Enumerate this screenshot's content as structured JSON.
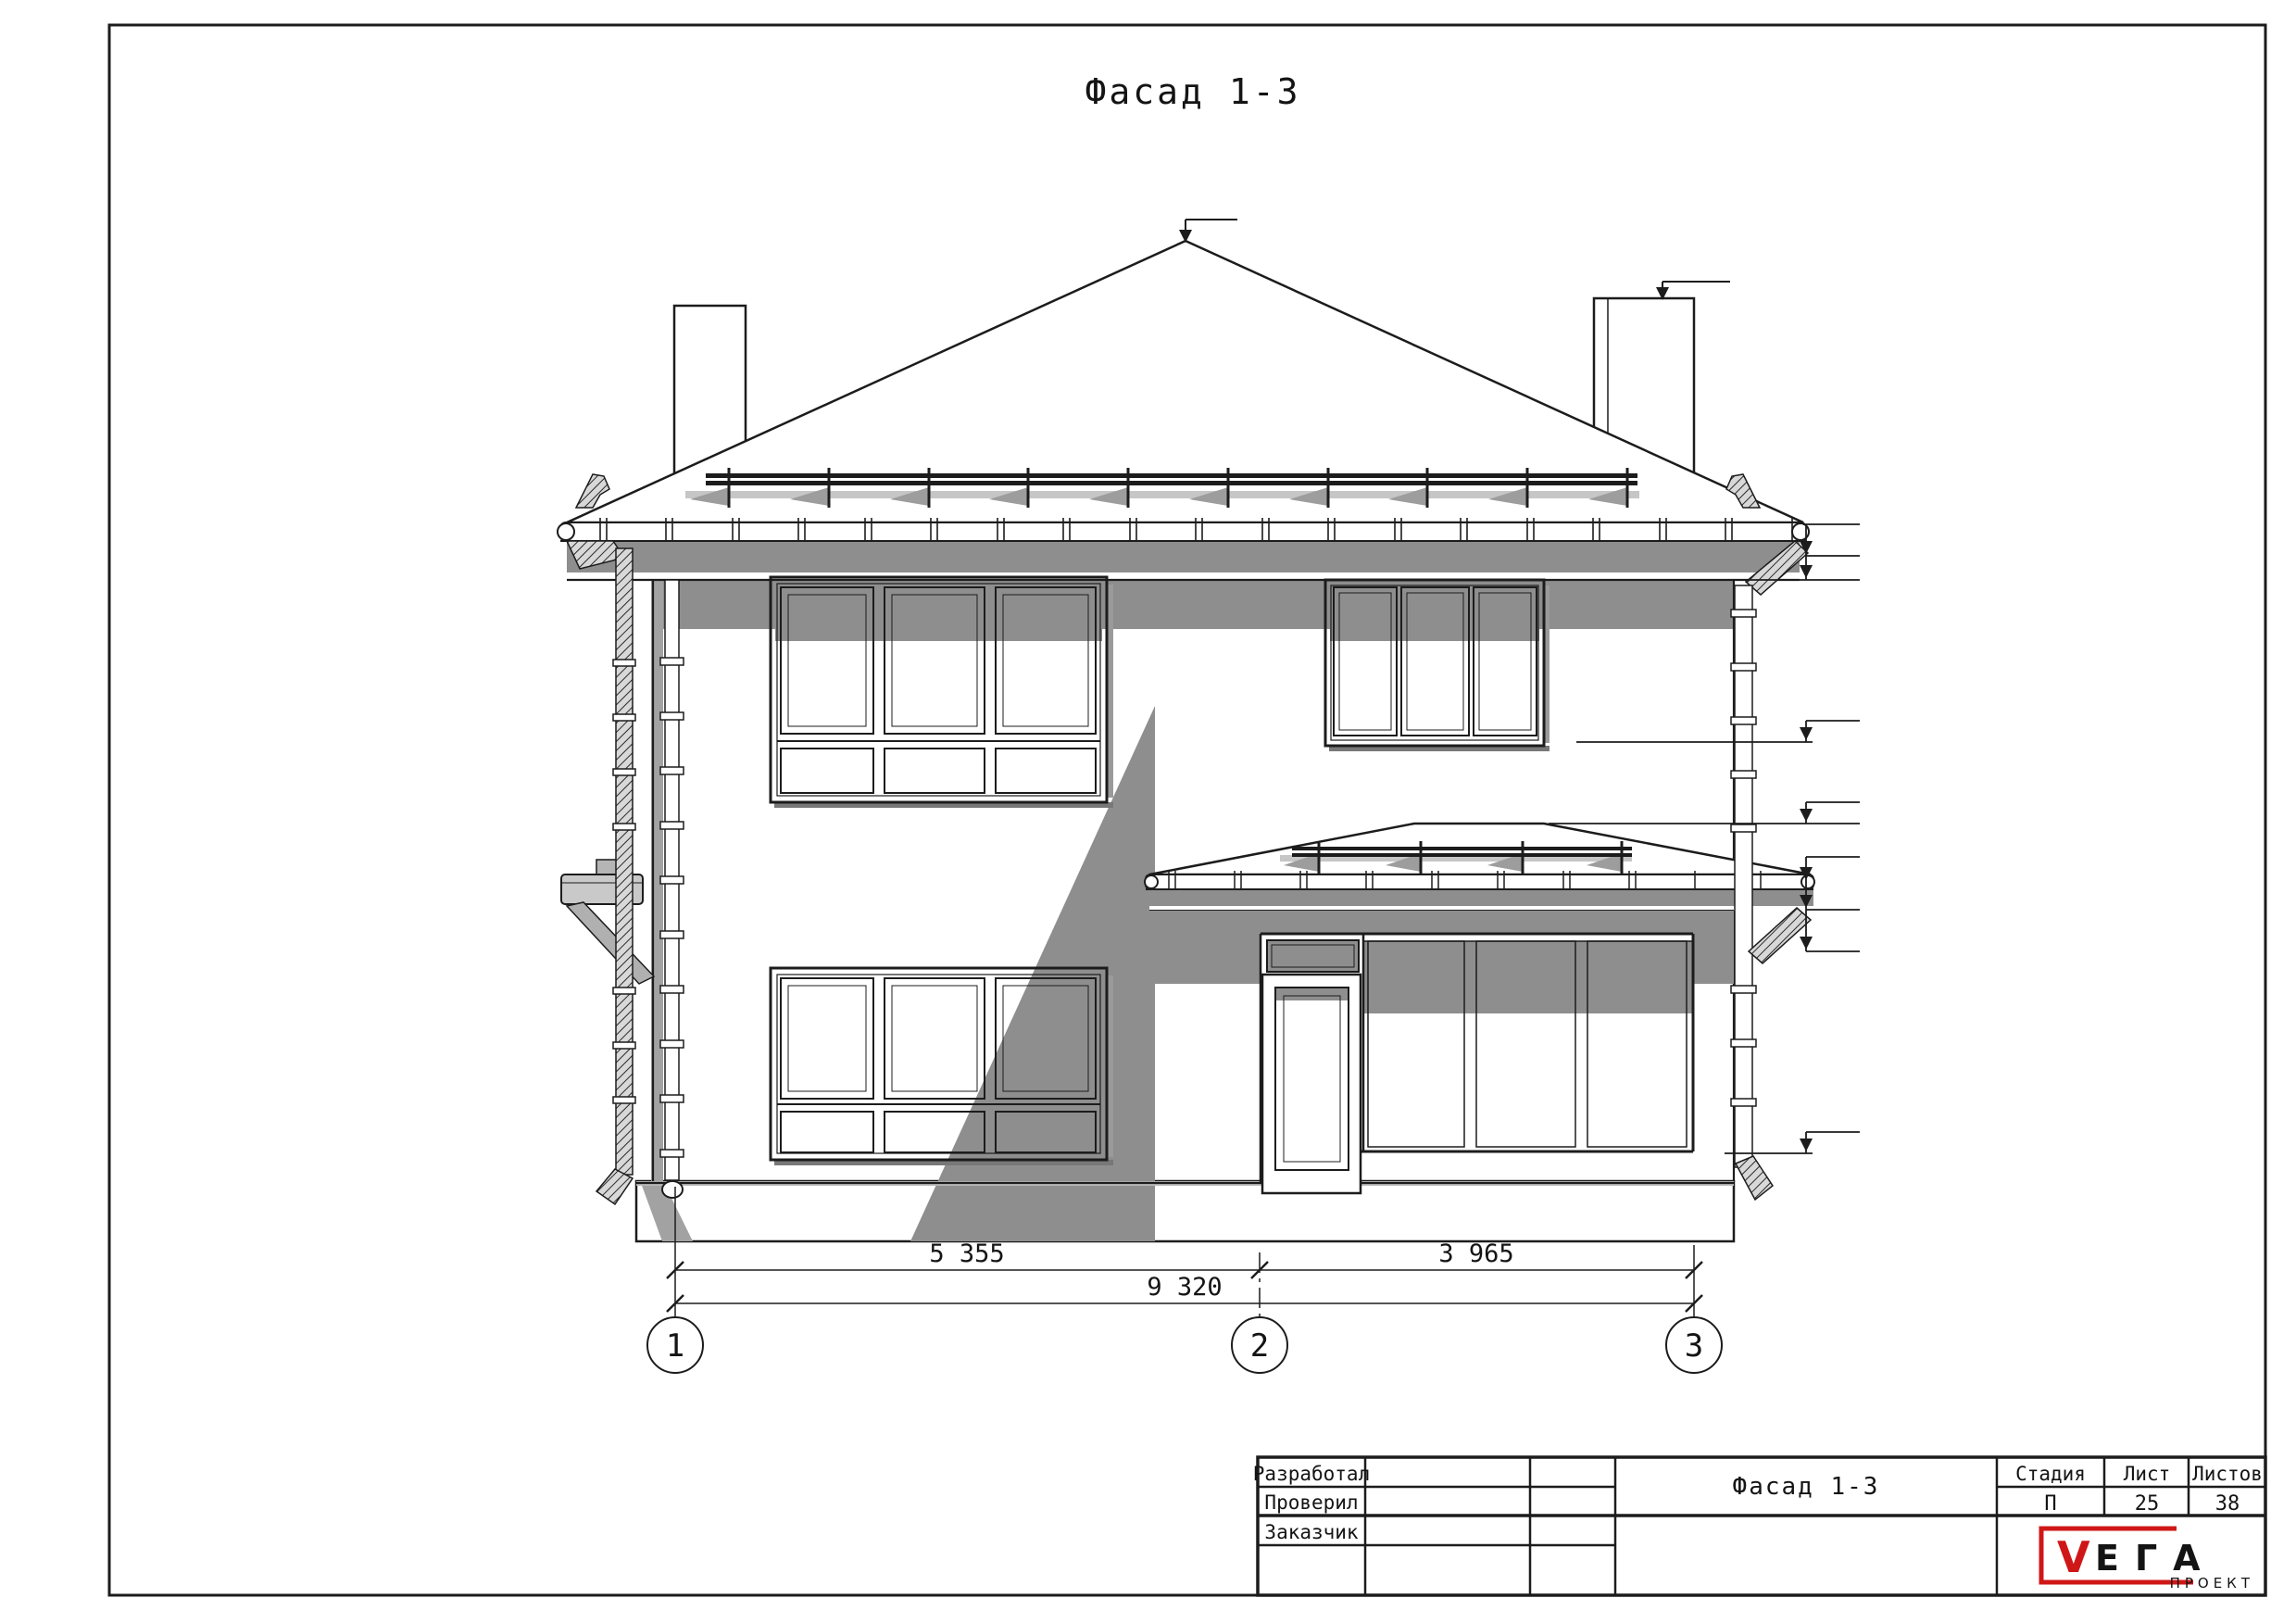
{
  "sheet": {
    "title": "Фасад 1-3"
  },
  "dimensions": {
    "segment_1_2": "5 355",
    "segment_2_3": "3 965",
    "overall": "9 320"
  },
  "axes": [
    {
      "label": "1"
    },
    {
      "label": "2"
    },
    {
      "label": "3"
    }
  ],
  "title_block": {
    "rows": [
      {
        "label": "Разработал"
      },
      {
        "label": "Проверил"
      },
      {
        "label": "Заказчик"
      }
    ],
    "doc_title": "Фасад 1-3",
    "stage_header": "Стадия",
    "sheet_header": "Лист",
    "sheets_header": "Листов",
    "stage_value": "П",
    "sheet_value": "25",
    "sheets_value": "38",
    "logo": {
      "v": "V",
      "ega": "ЕГА",
      "sub": "ПРОЕКТ"
    }
  },
  "colors": {
    "line": "#1c1c1c",
    "shadow": "#8e8e8e",
    "logo_red": "#cf1717",
    "paper": "#ffffff"
  }
}
